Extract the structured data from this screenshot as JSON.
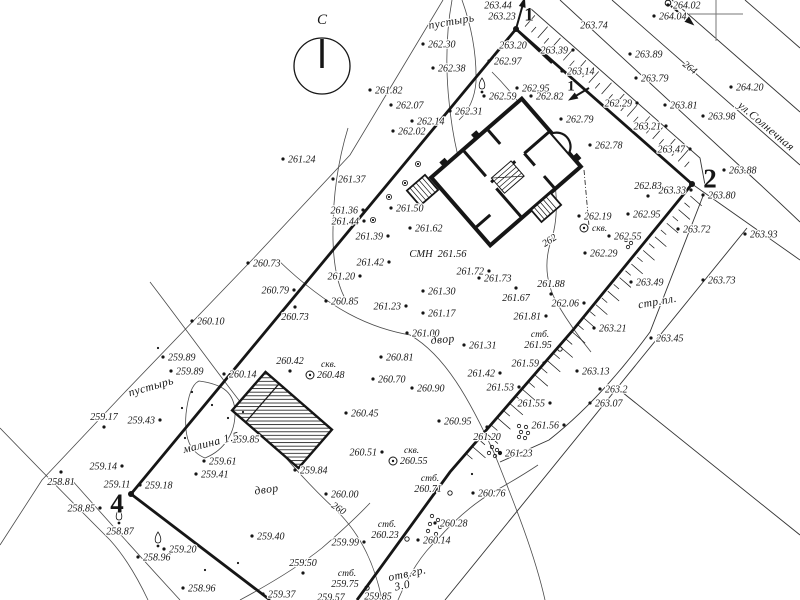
{
  "map_colors": {
    "ink": "#161616",
    "contour": "#4a4a4a",
    "paper": "#ffffff"
  },
  "north_arrow": {
    "label": "С",
    "x": 322,
    "y": 24,
    "cx": 322,
    "cy": 66,
    "r": 28
  },
  "contour_labels": [
    {
      "value": "260",
      "x": 337,
      "y": 511,
      "rot": 33
    },
    {
      "value": "262",
      "x": 551,
      "y": 243,
      "rot": -33
    },
    {
      "value": "264",
      "x": 688,
      "y": 70,
      "rot": 38
    }
  ],
  "area_labels": [
    {
      "text": "пустырь",
      "x": 452,
      "y": 25,
      "rot": -10
    },
    {
      "text": "пустырь",
      "x": 152,
      "y": 390,
      "rot": -16
    },
    {
      "text": "двор",
      "x": 443,
      "y": 343,
      "rot": -5
    },
    {
      "text": "двор",
      "x": 267,
      "y": 493,
      "rot": -8
    },
    {
      "text": "стр.пл.",
      "x": 658,
      "y": 305,
      "rot": -10
    },
    {
      "text": "малина 1.5",
      "x": 212,
      "y": 446,
      "rot": -14
    },
    {
      "text": "отв.гр.",
      "x": 408,
      "y": 577,
      "rot": -12
    },
    {
      "text": "3.0",
      "x": 403,
      "y": 589,
      "rot": -12
    },
    {
      "text": "ул.Солнечная",
      "x": 764,
      "y": 129,
      "rot": 40
    }
  ],
  "benchmark": {
    "code": "СМН",
    "value": "261.56",
    "x": 421,
    "y": 257
  },
  "corner_points": [
    {
      "number": "1",
      "x": 529,
      "y": 14,
      "size": 19,
      "dot": [
        516,
        29
      ],
      "arrow": [
        516,
        29,
        523,
        4
      ]
    },
    {
      "number": "1",
      "x": 571,
      "y": 85,
      "size": 15,
      "arrow": [
        589,
        88,
        574,
        97
      ]
    },
    {
      "number": "2",
      "x": 710,
      "y": 178,
      "size": 27,
      "dot": [
        692,
        184
      ]
    },
    {
      "number": "4",
      "x": 117,
      "y": 503,
      "size": 27,
      "dot": [
        131,
        494
      ]
    }
  ],
  "boreholes": [
    {
      "label": "скв.",
      "value": "262.19",
      "x": 584,
      "y": 228,
      "vpos": "above"
    },
    {
      "label": "скв.",
      "value": "260.48",
      "x": 310,
      "y": 375,
      "vpos": "right"
    },
    {
      "label": "скв.",
      "value": "260.55",
      "x": 393,
      "y": 461,
      "vpos": "right"
    }
  ],
  "posts": [
    {
      "label": "стб.",
      "value": "261.95",
      "x": 538,
      "y": 347
    },
    {
      "label": "стб.",
      "value": "260.71",
      "x": 428,
      "y": 491
    },
    {
      "label": "стб.",
      "value": "260.23",
      "x": 385,
      "y": 537
    },
    {
      "label": "стб.",
      "value": "259.75",
      "x": 345,
      "y": 586
    }
  ],
  "spot_elevations": [
    {
      "v": "263.44",
      "x": 498,
      "y": 5,
      "s": "n"
    },
    {
      "v": "263.23",
      "x": 502,
      "y": 16,
      "s": "n"
    },
    {
      "v": "263.20",
      "x": 513,
      "y": 45,
      "s": "n"
    },
    {
      "v": "262.97",
      "x": 489,
      "y": 61
    },
    {
      "v": "262.30",
      "x": 423,
      "y": 44
    },
    {
      "v": "262.38",
      "x": 433,
      "y": 68
    },
    {
      "v": "261.82",
      "x": 370,
      "y": 90
    },
    {
      "v": "262.07",
      "x": 391,
      "y": 105
    },
    {
      "v": "262.59",
      "x": 484,
      "y": 96
    },
    {
      "v": "262.31",
      "x": 450,
      "y": 111
    },
    {
      "v": "262.14",
      "x": 412,
      "y": 121
    },
    {
      "v": "262.02",
      "x": 393,
      "y": 131
    },
    {
      "v": "262.95",
      "x": 517,
      "y": 88
    },
    {
      "v": "262.82",
      "x": 531,
      "y": 96
    },
    {
      "v": "262.79",
      "x": 561,
      "y": 119
    },
    {
      "v": "262.78",
      "x": 590,
      "y": 145
    },
    {
      "v": "263.74",
      "x": 594,
      "y": 25,
      "s": "n"
    },
    {
      "v": "263.39",
      "x": 573,
      "y": 50,
      "s": "l"
    },
    {
      "v": "263.14",
      "x": 562,
      "y": 71
    },
    {
      "v": "263.89",
      "x": 630,
      "y": 54
    },
    {
      "v": "264.02",
      "x": 668,
      "y": 5
    },
    {
      "v": "264.04",
      "x": 654,
      "y": 16
    },
    {
      "v": "264.20",
      "x": 731,
      "y": 87
    },
    {
      "v": "263.79",
      "x": 636,
      "y": 78
    },
    {
      "v": "262.29",
      "x": 637,
      "y": 103,
      "s": "l"
    },
    {
      "v": "263.81",
      "x": 665,
      "y": 105
    },
    {
      "v": "263.98",
      "x": 703,
      "y": 116
    },
    {
      "v": "263.21",
      "x": 666,
      "y": 126,
      "s": "l"
    },
    {
      "v": "263.47",
      "x": 690,
      "y": 149,
      "s": "l"
    },
    {
      "v": "263.88",
      "x": 724,
      "y": 170
    },
    {
      "v": "263.33",
      "x": 691,
      "y": 190,
      "s": "l"
    },
    {
      "v": "263.80",
      "x": 703,
      "y": 195
    },
    {
      "v": "262.83",
      "x": 648,
      "y": 196,
      "s": "a"
    },
    {
      "v": "262.95",
      "x": 628,
      "y": 214
    },
    {
      "v": "263.72",
      "x": 678,
      "y": 229
    },
    {
      "v": "263.93",
      "x": 745,
      "y": 234
    },
    {
      "v": "262.55",
      "x": 609,
      "y": 236
    },
    {
      "v": "262.29",
      "x": 585,
      "y": 253
    },
    {
      "v": "263.49",
      "x": 631,
      "y": 282
    },
    {
      "v": "263.73",
      "x": 703,
      "y": 280
    },
    {
      "v": "262.06",
      "x": 584,
      "y": 303,
      "s": "l"
    },
    {
      "v": "263.21",
      "x": 594,
      "y": 328
    },
    {
      "v": "263.45",
      "x": 651,
      "y": 338
    },
    {
      "v": "263.13",
      "x": 577,
      "y": 371
    },
    {
      "v": "263.2",
      "x": 600,
      "y": 389
    },
    {
      "v": "263.07",
      "x": 590,
      "y": 403
    },
    {
      "v": "262.19",
      "x": 579,
      "y": 216
    },
    {
      "v": "261.24",
      "x": 283,
      "y": 159
    },
    {
      "v": "261.37",
      "x": 333,
      "y": 179
    },
    {
      "v": "261.36",
      "x": 363,
      "y": 210,
      "s": "l"
    },
    {
      "v": "261.44",
      "x": 364,
      "y": 221,
      "s": "l"
    },
    {
      "v": "261.50",
      "x": 391,
      "y": 208
    },
    {
      "v": "261.62",
      "x": 410,
      "y": 228
    },
    {
      "v": "261.39",
      "x": 388,
      "y": 236,
      "s": "l"
    },
    {
      "v": "261.42",
      "x": 389,
      "y": 262,
      "s": "l"
    },
    {
      "v": "261.20",
      "x": 360,
      "y": 276,
      "s": "l"
    },
    {
      "v": "261.72",
      "x": 489,
      "y": 271,
      "s": "l"
    },
    {
      "v": "261.73",
      "x": 479,
      "y": 278
    },
    {
      "v": "261.88",
      "x": 551,
      "y": 294,
      "s": "a"
    },
    {
      "v": "261.67",
      "x": 516,
      "y": 288,
      "s": "b"
    },
    {
      "v": "261.81",
      "x": 546,
      "y": 316,
      "s": "l"
    },
    {
      "v": "261.30",
      "x": 423,
      "y": 291
    },
    {
      "v": "261.23",
      "x": 406,
      "y": 306,
      "s": "l"
    },
    {
      "v": "261.17",
      "x": 423,
      "y": 313
    },
    {
      "v": "261.00",
      "x": 407,
      "y": 333
    },
    {
      "v": "261.31",
      "x": 464,
      "y": 345
    },
    {
      "v": "260.81",
      "x": 381,
      "y": 357
    },
    {
      "v": "261.59",
      "x": 544,
      "y": 363,
      "s": "l"
    },
    {
      "v": "260.70",
      "x": 373,
      "y": 379
    },
    {
      "v": "260.90",
      "x": 412,
      "y": 388
    },
    {
      "v": "261.42",
      "x": 500,
      "y": 373,
      "s": "l"
    },
    {
      "v": "261.53",
      "x": 519,
      "y": 387,
      "s": "l"
    },
    {
      "v": "261.55",
      "x": 550,
      "y": 403,
      "s": "l"
    },
    {
      "v": "261.56",
      "x": 564,
      "y": 425,
      "s": "l"
    },
    {
      "v": "260.95",
      "x": 439,
      "y": 421
    },
    {
      "v": "261.20",
      "x": 487,
      "y": 427,
      "s": "b"
    },
    {
      "v": "261.23",
      "x": 500,
      "y": 453
    },
    {
      "v": "260.76",
      "x": 473,
      "y": 493
    },
    {
      "v": "260.73",
      "x": 248,
      "y": 263
    },
    {
      "v": "260.79",
      "x": 294,
      "y": 290,
      "s": "l"
    },
    {
      "v": "260.85",
      "x": 326,
      "y": 301
    },
    {
      "v": "260.73",
      "x": 295,
      "y": 307,
      "s": "b"
    },
    {
      "v": "260.10",
      "x": 192,
      "y": 321
    },
    {
      "v": "260.45",
      "x": 346,
      "y": 413
    },
    {
      "v": "260.51",
      "x": 382,
      "y": 452,
      "s": "l"
    },
    {
      "v": "260.42",
      "x": 290,
      "y": 371,
      "s": "a"
    },
    {
      "v": "260.14",
      "x": 224,
      "y": 374
    },
    {
      "v": "259.89",
      "x": 163,
      "y": 357
    },
    {
      "v": "259.89",
      "x": 171,
      "y": 371
    },
    {
      "v": "259.43",
      "x": 160,
      "y": 420,
      "s": "l"
    },
    {
      "v": "259.17",
      "x": 104,
      "y": 427,
      "s": "a"
    },
    {
      "v": "259.85",
      "x": 227,
      "y": 439
    },
    {
      "v": "259.61",
      "x": 204,
      "y": 461
    },
    {
      "v": "259.41",
      "x": 196,
      "y": 474
    },
    {
      "v": "259.14",
      "x": 122,
      "y": 466,
      "s": "l"
    },
    {
      "v": "258.81",
      "x": 61,
      "y": 472,
      "s": "b"
    },
    {
      "v": "259.11",
      "x": 117,
      "y": 484,
      "s": "n"
    },
    {
      "v": "259.18",
      "x": 140,
      "y": 485
    },
    {
      "v": "258.85",
      "x": 100,
      "y": 508,
      "s": "l"
    },
    {
      "v": "258.87",
      "x": 120,
      "y": 531,
      "s": "n"
    },
    {
      "v": "259.20",
      "x": 164,
      "y": 549
    },
    {
      "v": "258.96",
      "x": 138,
      "y": 557
    },
    {
      "v": "258.96",
      "x": 183,
      "y": 588
    },
    {
      "v": "259.40",
      "x": 252,
      "y": 536
    },
    {
      "v": "259.50",
      "x": 303,
      "y": 573,
      "s": "a"
    },
    {
      "v": "259.37",
      "x": 263,
      "y": 594
    },
    {
      "v": "259.57",
      "x": 331,
      "y": 597,
      "s": "n"
    },
    {
      "v": "259.85",
      "x": 378,
      "y": 596,
      "s": "n"
    },
    {
      "v": "259.99",
      "x": 364,
      "y": 542,
      "s": "l"
    },
    {
      "v": "260.00",
      "x": 326,
      "y": 494
    },
    {
      "v": "259.84",
      "x": 295,
      "y": 470
    },
    {
      "v": "260.14",
      "x": 418,
      "y": 540
    },
    {
      "v": "260.28",
      "x": 435,
      "y": 523
    }
  ]
}
